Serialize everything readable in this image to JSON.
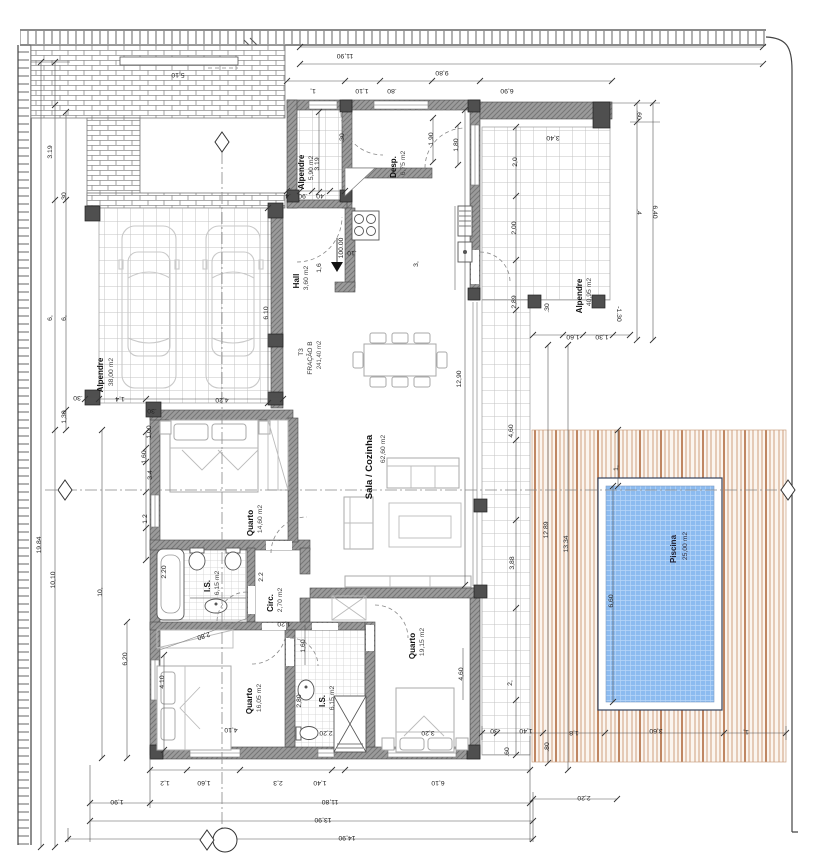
{
  "drawing": {
    "unit": {
      "type": "T3",
      "fraction": "FRAÇÃO B",
      "total_area": "241,40 m2"
    },
    "level": "100.00",
    "rooms": {
      "carport": {
        "name": "Alpendre",
        "area": "38,00 m2"
      },
      "porch": {
        "name": "Alpendre",
        "area": "5,90 m2"
      },
      "pantry": {
        "name": "Desp.",
        "area": "6,75 m2"
      },
      "hall": {
        "name": "Hall",
        "area": "3,60 m2"
      },
      "living": {
        "name": "Sala / Cozinha",
        "area": "62,60 m2"
      },
      "bedroom1": {
        "name": "Quarto",
        "area": "14,60 m2"
      },
      "bath1": {
        "name": "I.S.",
        "area": "6,15 m2"
      },
      "circ": {
        "name": "Circ.",
        "area": "2,70 m2"
      },
      "bedroom2": {
        "name": "Quarto",
        "area": "16,05 m2"
      },
      "bath2": {
        "name": "I.S.",
        "area": "6,15 m2"
      },
      "bedroom3": {
        "name": "Quarto",
        "area": "19,15 m2"
      },
      "terrace": {
        "name": "Alpendre",
        "area": "40,95 m2"
      },
      "pool": {
        "name": "Piscina",
        "area": "25,00 m2"
      }
    },
    "colors": {
      "pool_water": "#8cbbf0",
      "deck_wood": "#cf9e7d",
      "wall_gray": "#9b9b9b"
    },
    "dims": [
      "11,90",
      "9,80",
      "1,",
      "1,10",
      ".80",
      "6,90",
      "5,10",
      ".60",
      "3,40",
      "2,0",
      "2,00",
      "2,89",
      "6,40",
      ".4",
      "-1.30",
      ".30",
      "1,60",
      "1,30",
      "12.89",
      "13.34",
      "6,60",
      "1,",
      ".30",
      "1,40",
      "1,8",
      "3,60",
      "1,",
      ".60",
      ".80",
      "2,20",
      "1,2",
      "1,60",
      "2,3",
      "1,40",
      "6,10",
      "1,90",
      "11,80",
      "13,90",
      "14,90",
      "3.19",
      ".30",
      "6,",
      "6,",
      "1,30",
      "19.84",
      "10,10",
      "10,",
      "6,20",
      "4.10",
      "1,4",
      "4,20",
      ".30",
      "6.10",
      "1,00",
      "1,60",
      "3.4",
      "1.2",
      "2.20",
      "2.2",
      "2,80",
      "1,20",
      "1,60",
      "4,10",
      "2,20",
      "2,80",
      "3,20",
      "4,60",
      "12,90",
      "4,60",
      "3,88",
      "2,",
      "3,",
      ".10",
      "1,6",
      ".4",
      ".90",
      ".40",
      ".30",
      "1,90",
      "1,80",
      "3.19",
      ".30"
    ],
    "labels": [
      {
        "p": "rooms.carport.name",
        "n": "room-label-carport",
        "c": "rn",
        "x": 103,
        "y": 375,
        "r": -90
      },
      {
        "p": "rooms.carport.area",
        "n": "room-area-carport",
        "c": "ra",
        "x": 113,
        "y": 372,
        "r": -90
      },
      {
        "p": "rooms.porch.name",
        "n": "room-label-porch",
        "c": "rn",
        "x": 304,
        "y": 172,
        "r": -90
      },
      {
        "p": "rooms.porch.area",
        "n": "room-area-porch",
        "c": "ra",
        "x": 313,
        "y": 168,
        "r": -90
      },
      {
        "p": "rooms.pantry.name",
        "n": "room-label-pantry",
        "c": "rn",
        "x": 396,
        "y": 167,
        "r": -90
      },
      {
        "p": "rooms.pantry.area",
        "n": "room-area-pantry",
        "c": "ra",
        "x": 405,
        "y": 163,
        "r": -90
      },
      {
        "p": "rooms.hall.name",
        "n": "room-label-hall",
        "c": "rn",
        "x": 299,
        "y": 281,
        "r": -90
      },
      {
        "p": "rooms.hall.area",
        "n": "room-area-hall",
        "c": "ra",
        "x": 308,
        "y": 278,
        "r": -90
      },
      {
        "p": "rooms.living.name",
        "n": "room-label-living",
        "c": "rnL",
        "x": 372,
        "y": 467,
        "r": -90
      },
      {
        "p": "rooms.living.area",
        "n": "room-area-living",
        "c": "ra",
        "x": 385,
        "y": 449,
        "r": -90
      },
      {
        "p": "rooms.bedroom1.name",
        "n": "room-label-bedroom1",
        "c": "rn",
        "x": 253,
        "y": 523,
        "r": -90
      },
      {
        "p": "rooms.bedroom1.area",
        "n": "room-area-bedroom1",
        "c": "ra",
        "x": 262,
        "y": 519,
        "r": -90
      },
      {
        "p": "rooms.bath1.name",
        "n": "room-label-bath1",
        "c": "rn",
        "x": 210,
        "y": 586,
        "r": -90
      },
      {
        "p": "rooms.bath1.area",
        "n": "room-area-bath1",
        "c": "ra",
        "x": 219,
        "y": 583,
        "r": -90
      },
      {
        "p": "rooms.circ.name",
        "n": "room-label-circ",
        "c": "rn",
        "x": 273,
        "y": 603,
        "r": -90
      },
      {
        "p": "rooms.circ.area",
        "n": "room-area-circ",
        "c": "ra",
        "x": 282,
        "y": 600,
        "r": -90
      },
      {
        "p": "rooms.bedroom2.name",
        "n": "room-label-bedroom2",
        "c": "rn",
        "x": 252,
        "y": 701,
        "r": -90
      },
      {
        "p": "rooms.bedroom2.area",
        "n": "room-area-bedroom2",
        "c": "ra",
        "x": 261,
        "y": 698,
        "r": -90
      },
      {
        "p": "rooms.bath2.name",
        "n": "room-label-bath2",
        "c": "rn",
        "x": 325,
        "y": 701,
        "r": -90
      },
      {
        "p": "rooms.bath2.area",
        "n": "room-area-bath2",
        "c": "ra",
        "x": 334,
        "y": 698,
        "r": -90
      },
      {
        "p": "rooms.bedroom3.name",
        "n": "room-label-bedroom3",
        "c": "rn",
        "x": 415,
        "y": 646,
        "r": -90
      },
      {
        "p": "rooms.bedroom3.area",
        "n": "room-area-bedroom3",
        "c": "ra",
        "x": 424,
        "y": 642,
        "r": -90
      },
      {
        "p": "rooms.terrace.name",
        "n": "room-label-terrace",
        "c": "rn",
        "x": 582,
        "y": 296,
        "r": -90
      },
      {
        "p": "rooms.terrace.area",
        "n": "room-area-terrace",
        "c": "ra",
        "x": 591,
        "y": 292,
        "r": -90
      },
      {
        "p": "rooms.pool.name",
        "n": "room-label-pool",
        "c": "rnP",
        "x": 676,
        "y": 549,
        "r": -90
      },
      {
        "p": "rooms.pool.area",
        "n": "room-area-pool",
        "c": "raP",
        "x": 687,
        "y": 546,
        "r": -90
      },
      {
        "p": "unit.type",
        "n": "unit-type-label",
        "c": "t3",
        "x": 303,
        "y": 352,
        "r": -90
      },
      {
        "p": "unit.fraction",
        "n": "unit-fraction-label",
        "c": "t3",
        "x": 312,
        "y": 358,
        "r": -90
      },
      {
        "p": "unit.total_area",
        "n": "unit-area-label",
        "c": "t3s",
        "x": 321,
        "y": 355,
        "r": -90
      },
      {
        "p": "level",
        "n": "level-marker-label",
        "c": "d",
        "x": 343,
        "y": 248,
        "r": -90
      },
      {
        "p": "dims.0",
        "x": 345,
        "y": 54,
        "r": 180
      },
      {
        "p": "dims.1",
        "x": 442,
        "y": 71,
        "r": 180
      },
      {
        "p": "dims.2",
        "x": 313,
        "y": 89,
        "r": 180
      },
      {
        "p": "dims.3",
        "x": 362,
        "y": 89,
        "r": 180
      },
      {
        "p": "dims.4",
        "x": 392,
        "y": 89,
        "r": 180
      },
      {
        "p": "dims.5",
        "x": 507,
        "y": 89,
        "r": 180
      },
      {
        "p": "dims.6",
        "x": 178,
        "y": 73,
        "r": 180
      },
      {
        "p": "dims.7",
        "x": 637,
        "y": 115,
        "r": 90
      },
      {
        "p": "dims.8",
        "x": 553,
        "y": 136,
        "r": 180
      },
      {
        "p": "dims.9",
        "x": 517,
        "y": 162,
        "r": -90
      },
      {
        "p": "dims.10",
        "x": 516,
        "y": 228,
        "r": -90
      },
      {
        "p": "dims.11",
        "x": 516,
        "y": 302,
        "r": -90
      },
      {
        "p": "dims.12",
        "x": 653,
        "y": 212,
        "r": 90
      },
      {
        "p": "dims.13",
        "x": 637,
        "y": 212,
        "r": 90
      },
      {
        "p": "dims.14",
        "x": 617,
        "y": 314,
        "r": 90
      },
      {
        "p": "dims.15",
        "x": 549,
        "y": 308,
        "r": -90
      },
      {
        "p": "dims.16",
        "x": 573,
        "y": 335,
        "r": 180
      },
      {
        "p": "dims.17",
        "x": 602,
        "y": 335,
        "r": 180
      },
      {
        "p": "dims.18",
        "x": 548,
        "y": 530,
        "r": -90
      },
      {
        "p": "dims.19",
        "x": 568,
        "y": 544,
        "r": -90
      },
      {
        "p": "dims.20",
        "x": 613,
        "y": 601,
        "r": -90
      },
      {
        "p": "dims.21",
        "x": 618,
        "y": 468,
        "r": -90
      },
      {
        "p": "dims.22",
        "x": 495,
        "y": 729,
        "r": 180
      },
      {
        "p": "dims.23",
        "x": 526,
        "y": 729,
        "r": 180
      },
      {
        "p": "dims.24",
        "x": 574,
        "y": 731,
        "r": 180
      },
      {
        "p": "dims.25",
        "x": 656,
        "y": 729,
        "r": 180
      },
      {
        "p": "dims.26",
        "x": 746,
        "y": 730,
        "r": 180
      },
      {
        "p": "dims.27",
        "x": 509,
        "y": 752,
        "r": -90
      },
      {
        "p": "dims.28",
        "x": 549,
        "y": 747,
        "r": -90
      },
      {
        "p": "dims.29",
        "x": 584,
        "y": 796,
        "r": 180
      },
      {
        "p": "dims.30",
        "x": 165,
        "y": 781,
        "r": 180
      },
      {
        "p": "dims.31",
        "x": 204,
        "y": 781,
        "r": 180
      },
      {
        "p": "dims.32",
        "x": 278,
        "y": 781,
        "r": 180
      },
      {
        "p": "dims.33",
        "x": 320,
        "y": 781,
        "r": 180
      },
      {
        "p": "dims.34",
        "x": 438,
        "y": 781,
        "r": 180
      },
      {
        "p": "dims.35",
        "x": 117,
        "y": 800,
        "r": 180
      },
      {
        "p": "dims.36",
        "x": 330,
        "y": 800,
        "r": 180
      },
      {
        "p": "dims.37",
        "x": 323,
        "y": 818,
        "r": 180
      },
      {
        "p": "dims.38",
        "x": 347,
        "y": 836,
        "r": 180
      },
      {
        "p": "dims.39",
        "x": 52,
        "y": 152,
        "r": -90
      },
      {
        "p": "dims.40",
        "x": 66,
        "y": 197,
        "r": -90
      },
      {
        "p": "dims.41",
        "x": 52,
        "y": 318,
        "r": -90
      },
      {
        "p": "dims.42",
        "x": 66,
        "y": 318,
        "r": -90
      },
      {
        "p": "dims.43",
        "x": 66,
        "y": 417,
        "r": -90
      },
      {
        "p": "dims.44",
        "x": 41,
        "y": 545,
        "r": -90
      },
      {
        "p": "dims.45",
        "x": 55,
        "y": 580,
        "r": -90
      },
      {
        "p": "dims.46",
        "x": 102,
        "y": 592,
        "r": -90
      },
      {
        "p": "dims.47",
        "x": 127,
        "y": 659,
        "r": -90
      },
      {
        "p": "dims.48",
        "x": 164,
        "y": 682,
        "r": -90
      },
      {
        "p": "dims.49",
        "x": 120,
        "y": 397,
        "r": 180
      },
      {
        "p": "dims.50",
        "x": 222,
        "y": 398,
        "r": 180
      },
      {
        "p": "dims.51",
        "x": 78,
        "y": 396,
        "r": 180
      },
      {
        "p": "dims.52",
        "x": 268,
        "y": 313,
        "r": -90
      },
      {
        "p": "dims.53",
        "x": 151,
        "y": 432,
        "r": -90
      },
      {
        "p": "dims.54",
        "x": 146,
        "y": 457,
        "r": -90
      },
      {
        "p": "dims.55",
        "x": 152,
        "y": 475,
        "r": -90
      },
      {
        "p": "dims.56",
        "x": 147,
        "y": 519,
        "r": -90
      },
      {
        "p": "dims.57",
        "x": 166,
        "y": 572,
        "r": -90
      },
      {
        "p": "dims.58",
        "x": 263,
        "y": 577,
        "r": -90
      },
      {
        "p": "dims.59",
        "x": 203,
        "y": 634,
        "r": 161
      },
      {
        "p": "dims.60",
        "x": 284,
        "y": 622,
        "r": 180
      },
      {
        "p": "dims.61",
        "x": 305,
        "y": 646,
        "r": -90
      },
      {
        "p": "dims.62",
        "x": 231,
        "y": 728,
        "r": 180
      },
      {
        "p": "dims.63",
        "x": 326,
        "y": 731,
        "r": 180
      },
      {
        "p": "dims.64",
        "x": 301,
        "y": 701,
        "r": -90
      },
      {
        "p": "dims.65",
        "x": 428,
        "y": 731,
        "r": 180
      },
      {
        "p": "dims.66",
        "x": 463,
        "y": 674,
        "r": -90
      },
      {
        "p": "dims.67",
        "x": 461,
        "y": 379,
        "r": -90
      },
      {
        "p": "dims.68",
        "x": 513,
        "y": 431,
        "r": -90
      },
      {
        "p": "dims.69",
        "x": 514,
        "y": 563,
        "r": -90
      },
      {
        "p": "dims.70",
        "x": 512,
        "y": 683,
        "r": -90
      },
      {
        "p": "dims.71",
        "x": 418,
        "y": 264,
        "r": -90
      },
      {
        "p": "dims.72",
        "x": 352,
        "y": 251,
        "r": 180
      },
      {
        "p": "dims.73",
        "x": 321,
        "y": 268,
        "r": -90
      },
      {
        "p": "dims.74",
        "x": 288,
        "y": 194,
        "r": 180
      },
      {
        "p": "dims.75",
        "x": 303,
        "y": 194,
        "r": 180
      },
      {
        "p": "dims.76",
        "x": 321,
        "y": 194,
        "r": 180
      },
      {
        "p": "dims.77",
        "x": 344,
        "y": 138,
        "r": -90
      },
      {
        "p": "dims.78",
        "x": 433,
        "y": 139,
        "r": -90
      },
      {
        "p": "dims.79",
        "x": 458,
        "y": 145,
        "r": -90
      },
      {
        "p": "dims.80",
        "x": 319,
        "y": 164,
        "r": -90
      },
      {
        "p": "dims.81",
        "x": 152,
        "y": 409,
        "r": 180
      }
    ]
  }
}
